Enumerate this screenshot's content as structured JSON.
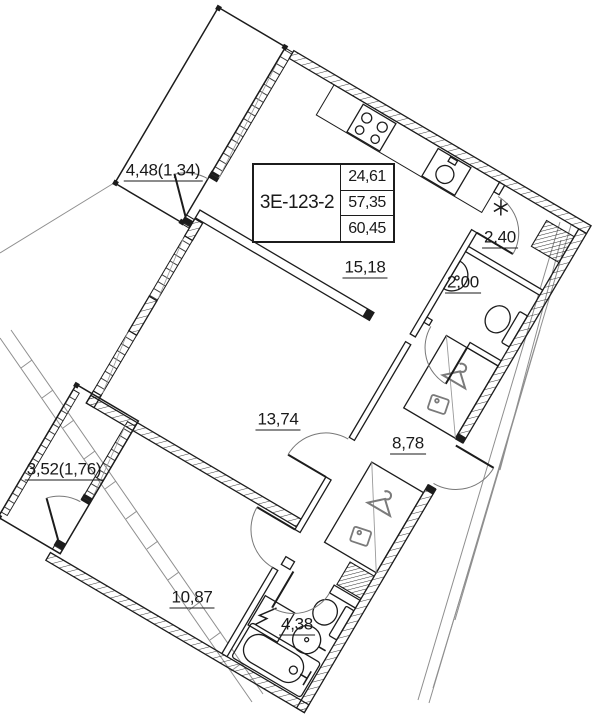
{
  "document": {
    "kind": "apartment floor plan"
  },
  "title_block": {
    "unit_code": "3Е-123-2",
    "living_area": "24,61",
    "area_no_balcony": "57,35",
    "total_area": "60,45"
  },
  "rooms": [
    {
      "id": "balcony-top",
      "area_label": "4,48(1,34)"
    },
    {
      "id": "kitchen-living",
      "area_label": "15,18"
    },
    {
      "id": "storage",
      "area_label": "2,40"
    },
    {
      "id": "wc",
      "area_label": "2,00"
    },
    {
      "id": "bedroom-middle",
      "area_label": "13,74"
    },
    {
      "id": "hallway",
      "area_label": "8,78"
    },
    {
      "id": "balcony-left",
      "area_label": "3,52(1,76)"
    },
    {
      "id": "bedroom-bottom",
      "area_label": "10,87"
    },
    {
      "id": "bathroom",
      "area_label": "4,38"
    }
  ],
  "colors": {
    "line": "#1c1c1c",
    "context": "#8f8f8f",
    "icon": "#7a7a7a",
    "bg": "#ffffff"
  }
}
